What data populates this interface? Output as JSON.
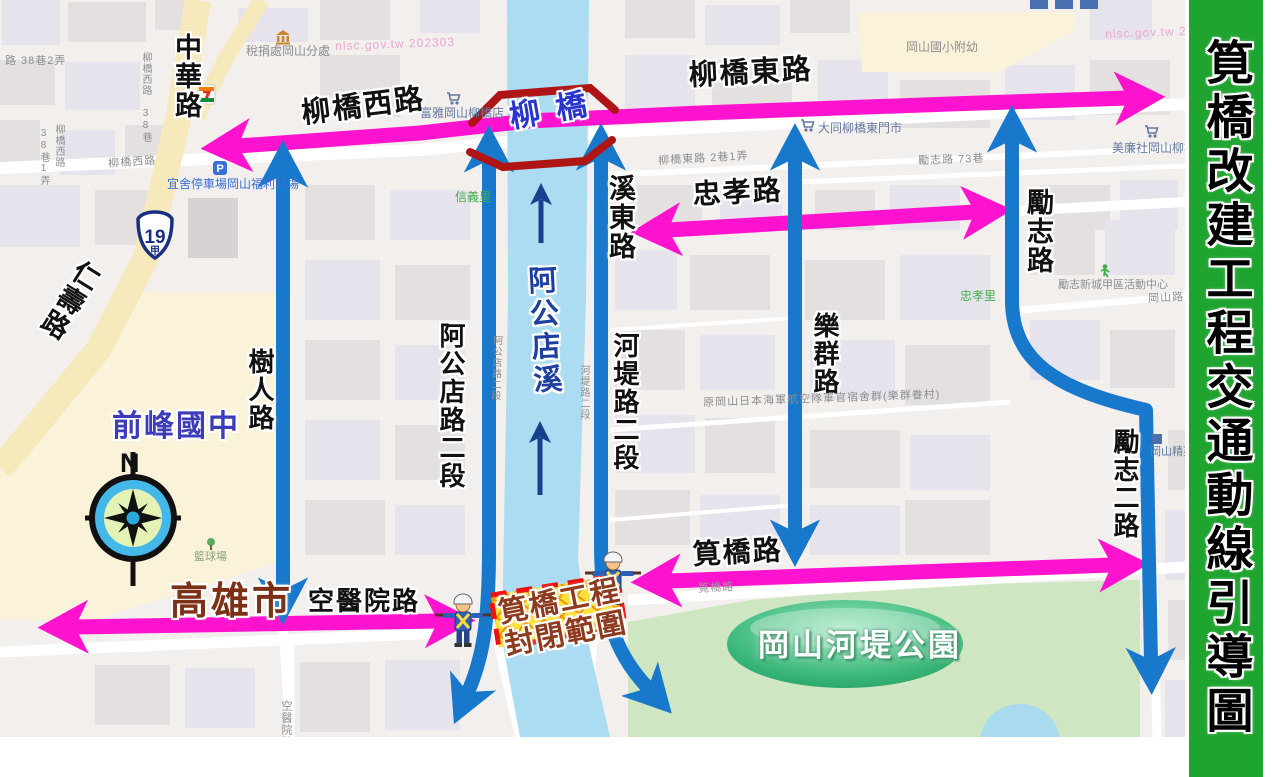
{
  "banner": {
    "title": "筧橋改建工程交通動線引導圖"
  },
  "colors": {
    "banner_green": "#1fa42f",
    "arrow_pink": "#ff13ce",
    "arrow_blue": "#1879cc",
    "river_blue": "#abdcf1",
    "flow_navy": "#16418f",
    "bridge_red": "#b01515",
    "closure_red": "#ee1111",
    "closure_yellow": "#ffe03a",
    "park_green": "#cfe6c2",
    "badge_green": "#2fae6e"
  },
  "compass": {
    "north": "N"
  },
  "route_shield": {
    "number": "19",
    "suffix": "甲"
  },
  "icons": {
    "parking_letter": "P"
  },
  "roads_major": {
    "zhonghua": "中華路",
    "liuqiao_west": "柳橋西路",
    "liuqiao_east": "柳橋東路",
    "xidong": "溪東路",
    "zhongxiao": "忠孝路",
    "lizhi": "勵志路",
    "renshou": "仁壽路",
    "shuren": "樹人路",
    "agongdian_2": "阿公店路二段",
    "hedi_2": "河堤路二段",
    "lequn": "樂群路",
    "lizhi_2": "勵志二路",
    "jianqiao": "筧橋路",
    "kongyiyuan": "空醫院路"
  },
  "places": {
    "bridge": "柳橋",
    "creek": "阿公店溪",
    "city": "高雄市",
    "school": "前峰國中",
    "park": "岡山河堤公園",
    "closure_line1": "筧橋工程",
    "closure_line2": "封閉範圍"
  },
  "small_labels": {
    "lane_38_2": "路 38巷2弄",
    "liuqiao_west_38": "柳橋西路 38巷",
    "lane_38_1": "38巷1弄",
    "liuqiao_west_v": "柳橋西路",
    "liuqiao_west_sm": "柳橋西路",
    "liuqiao_east_lane": "柳橋東路 2巷1弄",
    "lizhi_73": "勵志路 73巷",
    "gangshan_rd": "岡山路",
    "agongdian_sm": "阿公店路二段",
    "hedi_sm": "河堤路二段",
    "kongyiyuan_sm": "空醫院路",
    "navy_dorm": "原岡山日本海軍航空隊軍官宿舍群(樂群眷村)",
    "jianqiao_sm": "筧橋路",
    "watermark1": "nlsc.gov.tw 202303",
    "watermark2": "nlsc.gov.tw 2023"
  },
  "pois": {
    "tax_office": "稅捐處岡山分處",
    "parking_lot": "宜舍停車場岡山福利站場",
    "fuya_store": "富雅岡山柳橋店",
    "datong_store": "大同柳橋東門市",
    "meilian_store": "美廉社岡山柳橋東店",
    "elementary": "岡山國小附幼",
    "activity_center": "勵志新城甲區活動中心",
    "elite": "岡山精英",
    "xinyi_li": "信義里",
    "zhongxiao_li": "忠孝里",
    "basketball": "籃球場"
  }
}
